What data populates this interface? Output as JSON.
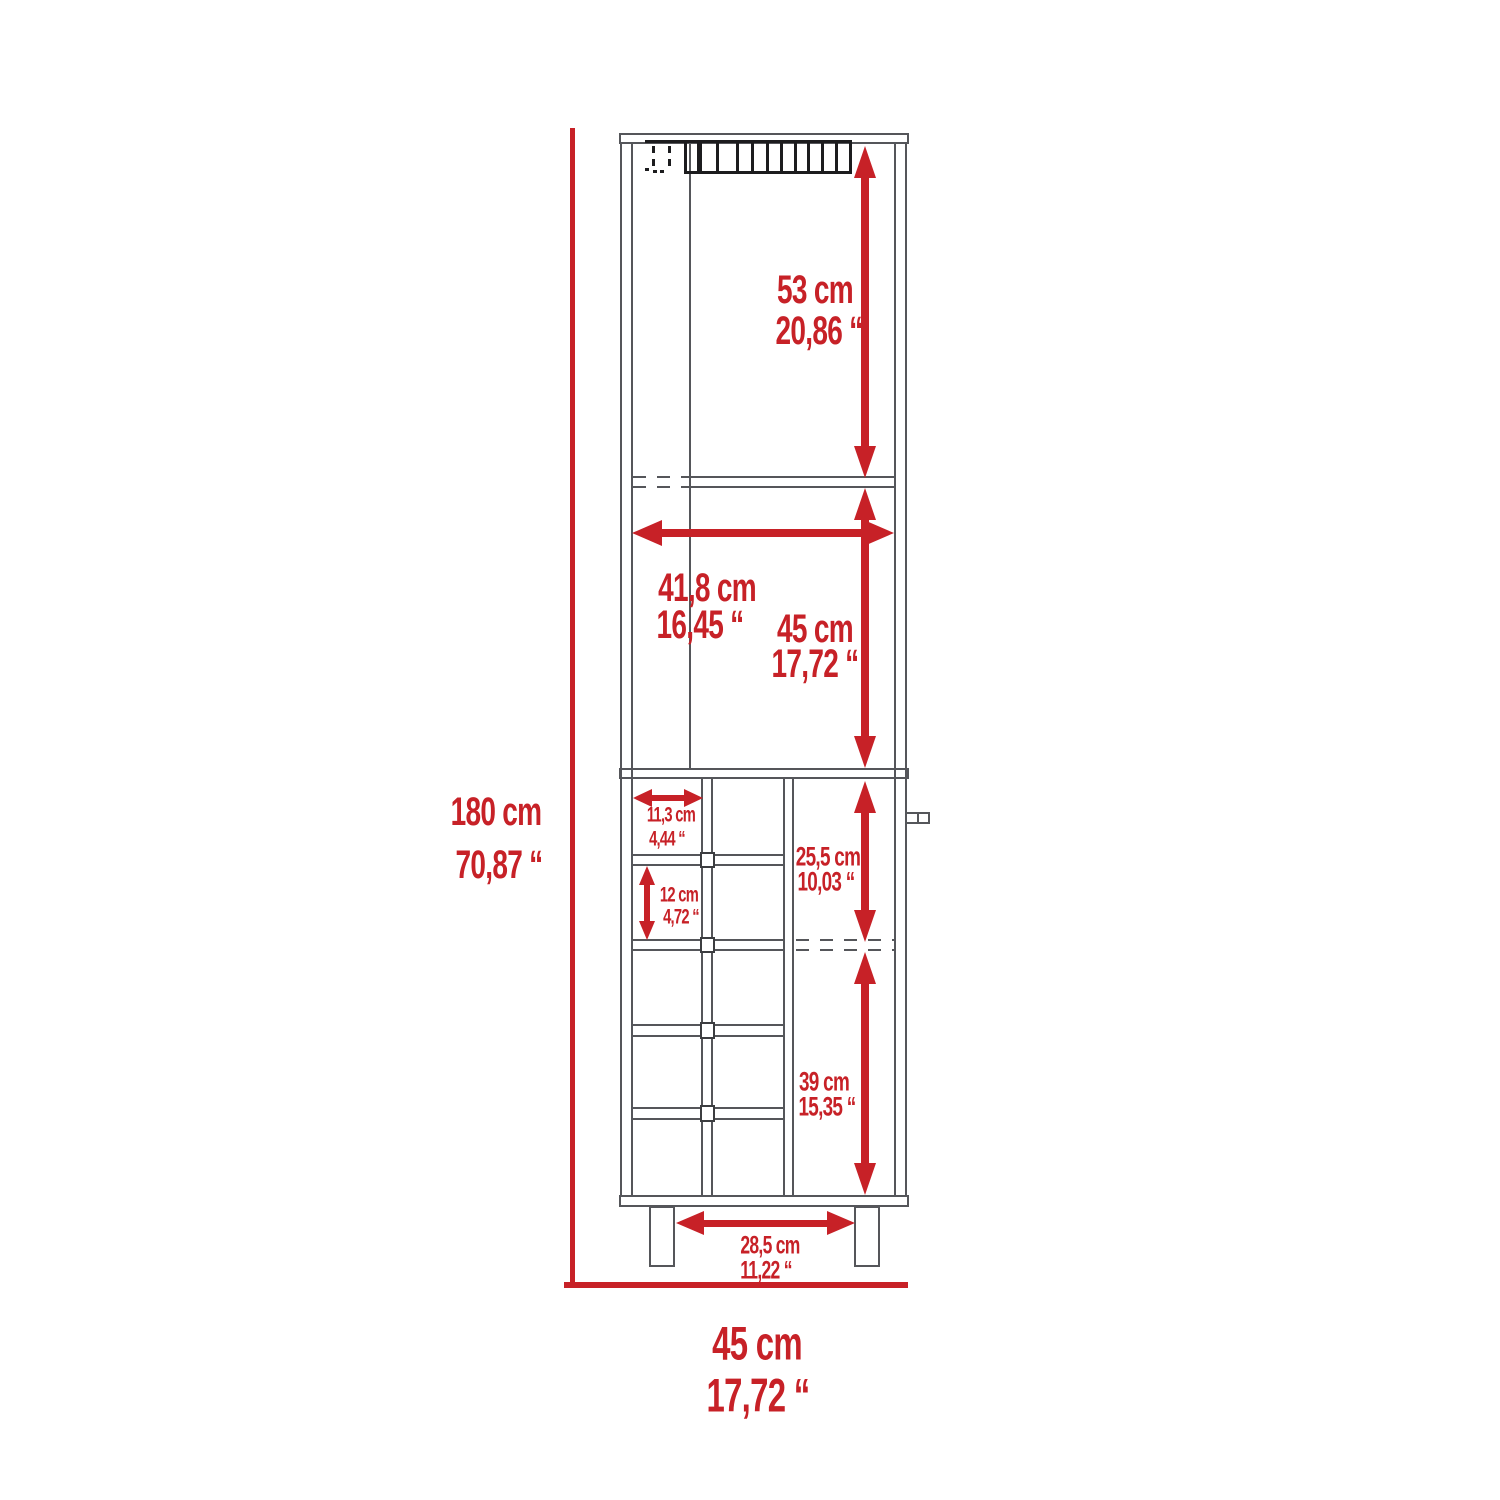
{
  "colors": {
    "dimension_red": "#c72127",
    "line_gray": "#55565a",
    "line_dark": "#1c1c1e",
    "background": "#ffffff"
  },
  "labels": {
    "total_height": {
      "cm": "180 cm",
      "inch": "70,87 “"
    },
    "total_width": {
      "cm": "45 cm",
      "inch": "17,72 “"
    },
    "top_section_height": {
      "cm": "53 cm",
      "inch": "20,86 “"
    },
    "interior_width": {
      "cm": "41,8 cm",
      "inch": "16,45 “"
    },
    "middle_section_height": {
      "cm": "45 cm",
      "inch": "17,72 “"
    },
    "cubby_width": {
      "cm": "11,3 cm",
      "inch": "4,44 “"
    },
    "cubby_height": {
      "cm": "12 cm",
      "inch": "4,72 “"
    },
    "door_upper_height": {
      "cm": "25,5 cm",
      "inch": "10,03 “"
    },
    "door_lower_height": {
      "cm": "39 cm",
      "inch": "15,35 “"
    },
    "leg_spacing": {
      "cm": "28,5 cm",
      "inch": "11,22 “"
    }
  }
}
